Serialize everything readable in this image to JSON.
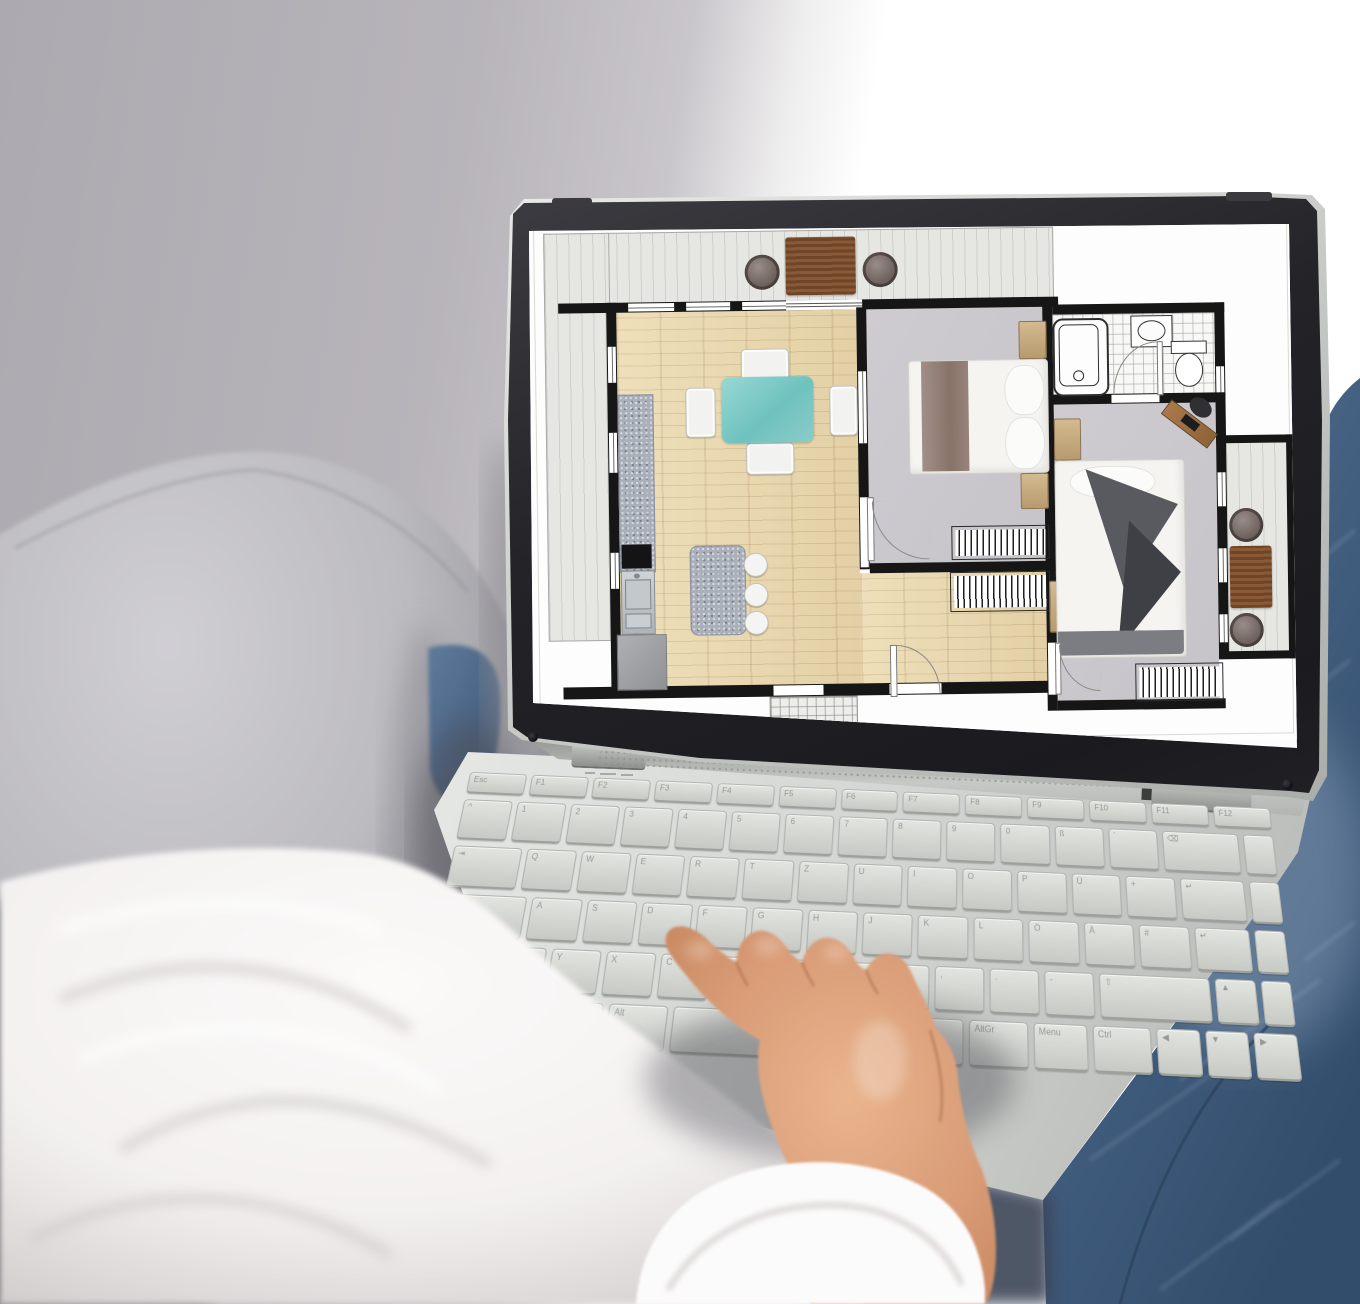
{
  "scene": {
    "type": "photograph",
    "description": "Person in a white shirt and blue jeans sitting on a gray sofa, typing on a silver laptop whose screen shows a 2-bedroom apartment floor plan",
    "colors": {
      "wall": "#b7b4ba",
      "window_light": "#ffffff",
      "couch_light": "#c9c8cd",
      "couch_dark": "#6c6b70",
      "fabric_white": "#f7f5f4",
      "skin": "#d89b75",
      "denim": "#456182",
      "laptop_silver": "#d6d8d5",
      "bezel": "#26262a",
      "screen": "#fcfcfc"
    }
  },
  "laptop": {
    "keyboard": {
      "layout": "QWERTZ",
      "rows": [
        {
          "h": 22,
          "keys": [
            [
              "Esc",
              1
            ],
            [
              "F1",
              1
            ],
            [
              "F2",
              1
            ],
            [
              "F3",
              1
            ],
            [
              "F4",
              1
            ],
            [
              "F5",
              1
            ],
            [
              "F6",
              1
            ],
            [
              "F7",
              1
            ],
            [
              "F8",
              1
            ],
            [
              "F9",
              1
            ],
            [
              "F10",
              1
            ],
            [
              "F11",
              1
            ],
            [
              "F12",
              1
            ]
          ]
        },
        {
          "h": 40,
          "keys": [
            [
              "^",
              1
            ],
            [
              "1",
              1
            ],
            [
              "2",
              1
            ],
            [
              "3",
              1
            ],
            [
              "4",
              1
            ],
            [
              "5",
              1
            ],
            [
              "6",
              1
            ],
            [
              "7",
              1
            ],
            [
              "8",
              1
            ],
            [
              "9",
              1
            ],
            [
              "0",
              1
            ],
            [
              "ß",
              1
            ],
            [
              "´",
              1
            ],
            [
              "⌫",
              1.6
            ],
            [
              "",
              0.6
            ]
          ]
        },
        {
          "h": 40,
          "keys": [
            [
              "⇥",
              1.4
            ],
            [
              "Q",
              1
            ],
            [
              "W",
              1
            ],
            [
              "E",
              1
            ],
            [
              "R",
              1
            ],
            [
              "T",
              1
            ],
            [
              "Z",
              1
            ],
            [
              "U",
              1
            ],
            [
              "I",
              1
            ],
            [
              "O",
              1
            ],
            [
              "P",
              1
            ],
            [
              "Ü",
              1
            ],
            [
              "+",
              1
            ],
            [
              "↵",
              1.3
            ],
            [
              "",
              0.6
            ]
          ]
        },
        {
          "h": 40,
          "keys": [
            [
              "⇪",
              1.7
            ],
            [
              "A",
              1
            ],
            [
              "S",
              1
            ],
            [
              "D",
              1
            ],
            [
              "F",
              1
            ],
            [
              "G",
              1
            ],
            [
              "H",
              1
            ],
            [
              "J",
              1
            ],
            [
              "K",
              1
            ],
            [
              "L",
              1
            ],
            [
              "Ö",
              1
            ],
            [
              "Ä",
              1
            ],
            [
              "#",
              1
            ],
            [
              "↵",
              1.1
            ],
            [
              "",
              0.6
            ]
          ]
        },
        {
          "h": 40,
          "keys": [
            [
              "⇧",
              1.2
            ],
            [
              "<",
              1
            ],
            [
              "Y",
              1
            ],
            [
              "X",
              1
            ],
            [
              "C",
              1
            ],
            [
              "V",
              1
            ],
            [
              "B",
              1
            ],
            [
              "N",
              1
            ],
            [
              "M",
              1
            ],
            [
              ",",
              1
            ],
            [
              ".",
              1
            ],
            [
              "-",
              1
            ],
            [
              "⇧",
              2.3
            ],
            [
              "▲",
              0.8
            ],
            [
              "",
              0.6
            ]
          ]
        },
        {
          "h": 40,
          "keys": [
            [
              "Ctrl",
              1.2
            ],
            [
              "Fn",
              1
            ],
            [
              "Win",
              1
            ],
            [
              "Alt",
              1.1
            ],
            [
              " ",
              5.6
            ],
            [
              "AltGr",
              1.1
            ],
            [
              "Menu",
              1
            ],
            [
              "Ctrl",
              1.1
            ],
            [
              "◀",
              0.8
            ],
            [
              "▼",
              0.8
            ],
            [
              "▶",
              0.8
            ]
          ]
        }
      ]
    }
  },
  "floor_plan": {
    "wall_color": "#161616",
    "rooms": [
      {
        "name": "terrace",
        "floor": "light gray planks"
      },
      {
        "name": "living-dining-kitchen",
        "floor": "light oak"
      },
      {
        "name": "bedroom-1",
        "floor": "gray"
      },
      {
        "name": "bathroom",
        "floor": "white tile"
      },
      {
        "name": "bedroom-2",
        "floor": "gray"
      },
      {
        "name": "hallway",
        "floor": "light oak"
      },
      {
        "name": "balcony",
        "floor": "light gray planks"
      }
    ],
    "furniture": [
      "terrace deck table",
      "2 terrace round chairs",
      "turquoise dining table",
      "4 white dining chairs",
      "kitchen counter",
      "cooktop",
      "kitchen sink",
      "fridge cabinet",
      "kitchen island",
      "3 bar stools",
      "double bed with taupe runner",
      "4 nightstands",
      "bathtub",
      "washbasin",
      "toilet",
      "double bed with white duvet",
      "desk with chair",
      "3 radiators",
      "balcony table",
      "2 balcony chairs"
    ]
  }
}
